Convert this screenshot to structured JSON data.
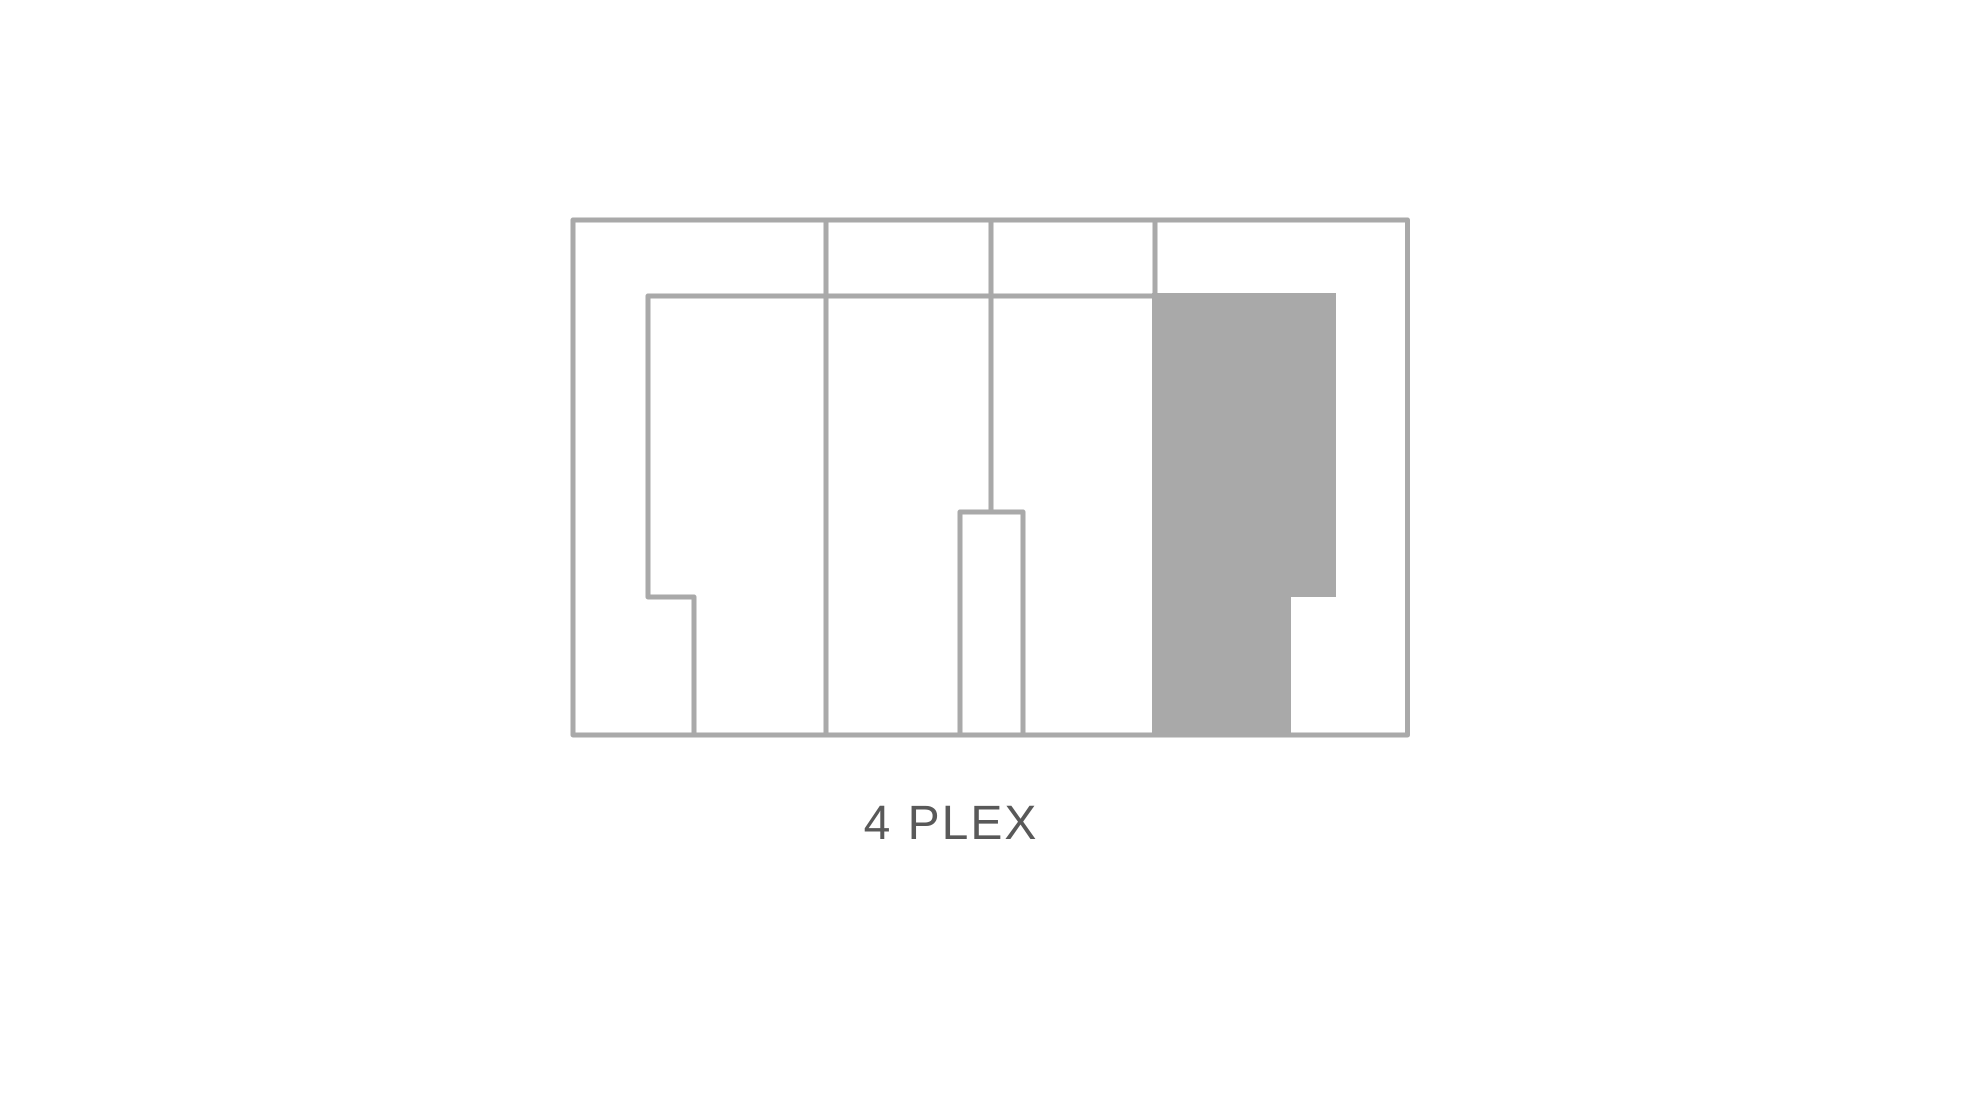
{
  "page": {
    "background_color": "#ffffff"
  },
  "diagram": {
    "label": "4 PLEX",
    "label_color": "#595959",
    "line_color": "#a9a9a9",
    "fill_color": "#a9a9a9",
    "stroke_width": 5,
    "canvas": {
      "width": 1980,
      "height": 1115
    },
    "building_outline": {
      "x": 573,
      "y": 220,
      "width": 834.5,
      "height": 515
    },
    "walls": [
      {
        "name": "unit1-inner-wall",
        "points": "694,737 694,597 648,597 648,296 1155,296"
      },
      {
        "name": "party-wall-1",
        "points": "826,220 826,735"
      },
      {
        "name": "party-wall-2",
        "points": "991,220 991,514"
      },
      {
        "name": "entry-recess",
        "points": "960,735 960,512 1023,512 1023,735"
      },
      {
        "name": "party-wall-3",
        "points": "1155,220 1155,735"
      }
    ],
    "shaded_unit": {
      "points": "1152,293 1336,293 1336,597 1291,597 1291,737 1152,737"
    }
  }
}
